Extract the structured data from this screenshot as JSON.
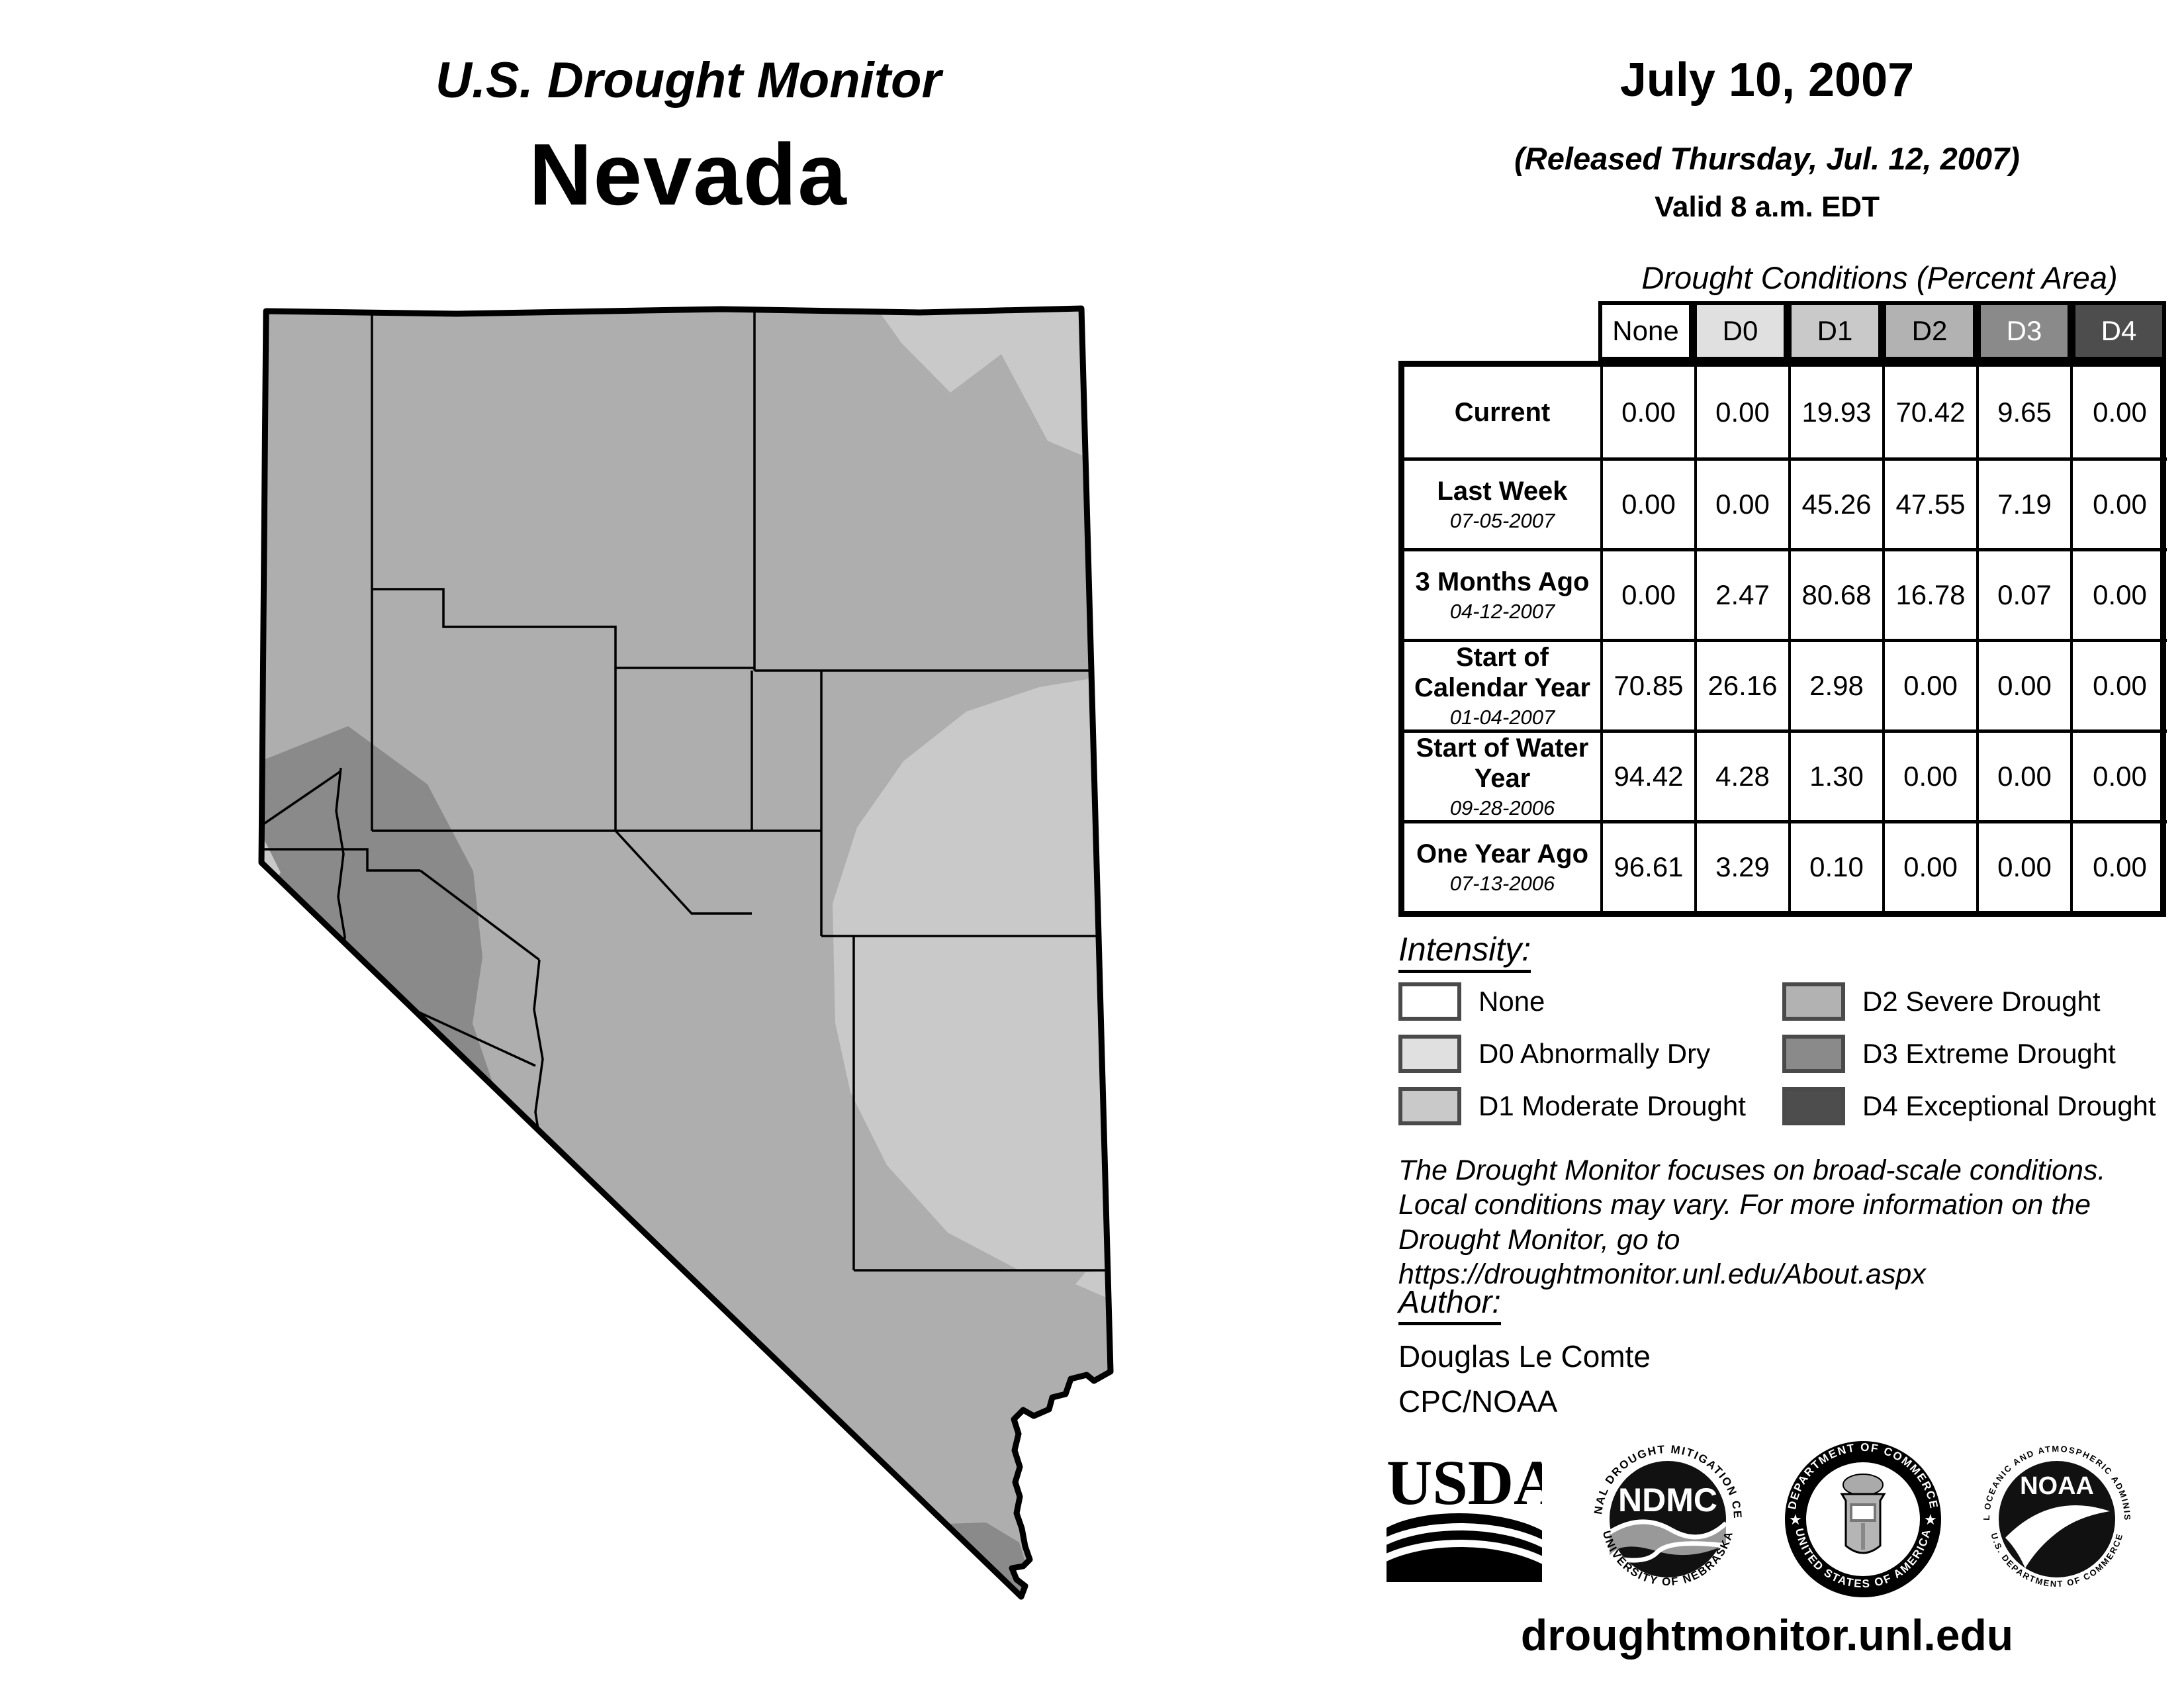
{
  "title": {
    "line1": "U.S. Drought Monitor",
    "line2": "Nevada"
  },
  "date_block": {
    "date": "July 10, 2007",
    "released": "(Released Thursday, Jul. 12, 2007)",
    "valid": "Valid 8 a.m. EDT"
  },
  "table": {
    "title": "Drought Conditions (Percent Area)",
    "columns": [
      "None",
      "D0",
      "D1",
      "D2",
      "D3",
      "D4"
    ],
    "header_fills": [
      "#ffffff",
      "#e0e0e0",
      "#c9c9c9",
      "#b2b2b2",
      "#8a8a8a",
      "#4d4d4d"
    ],
    "rows": [
      {
        "label": "Current",
        "date": "",
        "values": [
          "0.00",
          "0.00",
          "19.93",
          "70.42",
          "9.65",
          "0.00"
        ]
      },
      {
        "label": "Last Week",
        "date": "07-05-2007",
        "values": [
          "0.00",
          "0.00",
          "45.26",
          "47.55",
          "7.19",
          "0.00"
        ]
      },
      {
        "label": "3 Months Ago",
        "date": "04-12-2007",
        "values": [
          "0.00",
          "2.47",
          "80.68",
          "16.78",
          "0.07",
          "0.00"
        ]
      },
      {
        "label": "Start of Calendar Year",
        "date": "01-04-2007",
        "values": [
          "70.85",
          "26.16",
          "2.98",
          "0.00",
          "0.00",
          "0.00"
        ]
      },
      {
        "label": "Start of Water Year",
        "date": "09-28-2006",
        "values": [
          "94.42",
          "4.28",
          "1.30",
          "0.00",
          "0.00",
          "0.00"
        ]
      },
      {
        "label": "One Year Ago",
        "date": "07-13-2006",
        "values": [
          "96.61",
          "3.29",
          "0.10",
          "0.00",
          "0.00",
          "0.00"
        ]
      }
    ]
  },
  "legend": {
    "title": "Intensity:",
    "items": [
      {
        "label": "None",
        "color": "#ffffff",
        "col": 0
      },
      {
        "label": "D0 Abnormally Dry",
        "color": "#e0e0e0",
        "col": 0
      },
      {
        "label": "D1 Moderate Drought",
        "color": "#c9c9c9",
        "col": 0
      },
      {
        "label": "D2 Severe Drought",
        "color": "#b2b2b2",
        "col": 1
      },
      {
        "label": "D3 Extreme Drought",
        "color": "#8a8a8a",
        "col": 1
      },
      {
        "label": "D4 Exceptional Drought",
        "color": "#4d4d4d",
        "col": 1
      }
    ]
  },
  "disclaimer": "The Drought Monitor focuses on broad-scale conditions.\nLocal conditions may vary. For more information on the\nDrought Monitor, go to https://droughtmonitor.unl.edu/About.aspx",
  "author": {
    "label": "Author:",
    "name": "Douglas Le Comte",
    "org": "CPC/NOAA"
  },
  "footer": {
    "url": "droughtmonitor.unl.edu"
  },
  "logos": {
    "usda": {
      "text": "USDA"
    },
    "ndmc": {
      "center": "NDMC",
      "ring_top": "NATIONAL DROUGHT MITIGATION CENTER",
      "ring_bottom": "UNIVERSITY OF NEBRASKA"
    },
    "doc": {
      "ring_top": "DEPARTMENT OF COMMERCE",
      "ring_bottom": "UNITED STATES OF AMERICA"
    },
    "noaa": {
      "center": "NOAA",
      "ring_top": "NATIONAL OCEANIC AND ATMOSPHERIC ADMINISTRATION",
      "ring_bottom": "U.S. DEPARTMENT OF COMMERCE"
    }
  },
  "colors": {
    "none": "#ffffff",
    "d0": "#e0e0e0",
    "d1": "#c9c9c9",
    "d2": "#aeaeae",
    "d3": "#8a8a8a",
    "d4": "#4d4d4d",
    "swatch_border": "#4a4a4a",
    "line": "#000000"
  }
}
